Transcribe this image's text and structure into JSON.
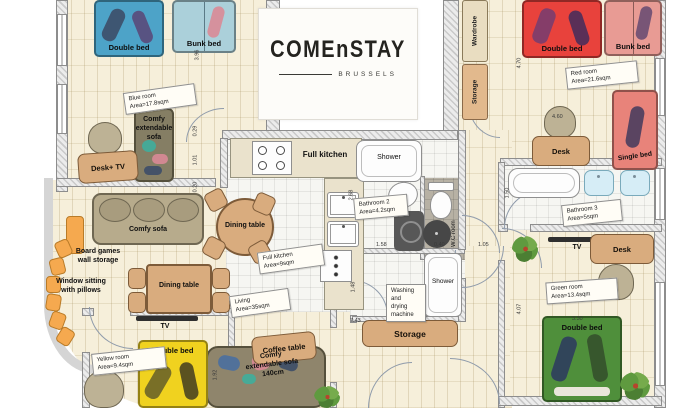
{
  "logo": {
    "title": "COMEnSTAY",
    "subtitle": "BRUSSELS"
  },
  "room_labels": {
    "blue_room": "Blue room\nArea=17.8sqm",
    "red_room": "Red room\nArea=21.6sqm",
    "yellow_room": "Yellow room\nArea=9.4sqm",
    "green_room": "Green room\nArea=13.4sqm",
    "living": "Living\nArea=35sqm",
    "full_kitchen_area": "Full kitchen\nArea=9sqm",
    "bathroom2": "Bathroom 2\nArea=4.2sqm",
    "bathroom3": "Bathroom 3\nArea=5sqm"
  },
  "furniture_labels": {
    "double_bed": "Double bed",
    "bunk_bed": "Bunk bed",
    "single_bed": "Single bed",
    "comfy_extendable_sofa": "Comfy\nextendable\nsofa",
    "comfy_extendable_sofa_140": "Comfy\nextendable sofa\n140cm",
    "comfy_sofa": "Comfy sofa",
    "desk_tv": "Desk+ TV",
    "desk": "Desk",
    "tv": "TV",
    "board_games": "Board games\nwall storage",
    "window_sitting": "Window sitting\nwith pillows",
    "dining_table": "Dining table",
    "coffee_table": "Coffee table",
    "full_kitchen": "Full kitchen",
    "shower": "Shower",
    "washing_machine": "Washing\nand\ndrying\nmachine",
    "storage": "Storage",
    "wardrobe": "Wardrobe",
    "wc_room": "W.C room"
  },
  "dimensions": {
    "sofa_blue": "3.77",
    "blue_h": "3.96",
    "hall_a": "0.29",
    "hall_b": "1.01",
    "hall_c": "0.20",
    "bath2_h": "2.68",
    "bath2_w": "1.58",
    "wc_w": "0.40",
    "corridor_w": "1.05",
    "wash_h": "1.48",
    "storage_w": "7.43",
    "red_h": "4.70",
    "red_desk": "4.60",
    "bath3_h": "1.50",
    "green_h": "4.07",
    "green_w": "3.30",
    "yellow_w": "1.92"
  },
  "colors": {
    "blue_bed": "#4da3c8",
    "light_blue_bed": "#abd0da",
    "red_bed": "#e8423c",
    "pink_bed": "#e89b94",
    "single_bed": "#e8837a",
    "yellow_bed": "#f0d21f",
    "green_bed": "#4f8f3b",
    "wood": "#d9ac7e",
    "sofa_gray": "#8f856c",
    "accent_orange": "#f5a94f",
    "floor_cream": "#f6efda"
  }
}
